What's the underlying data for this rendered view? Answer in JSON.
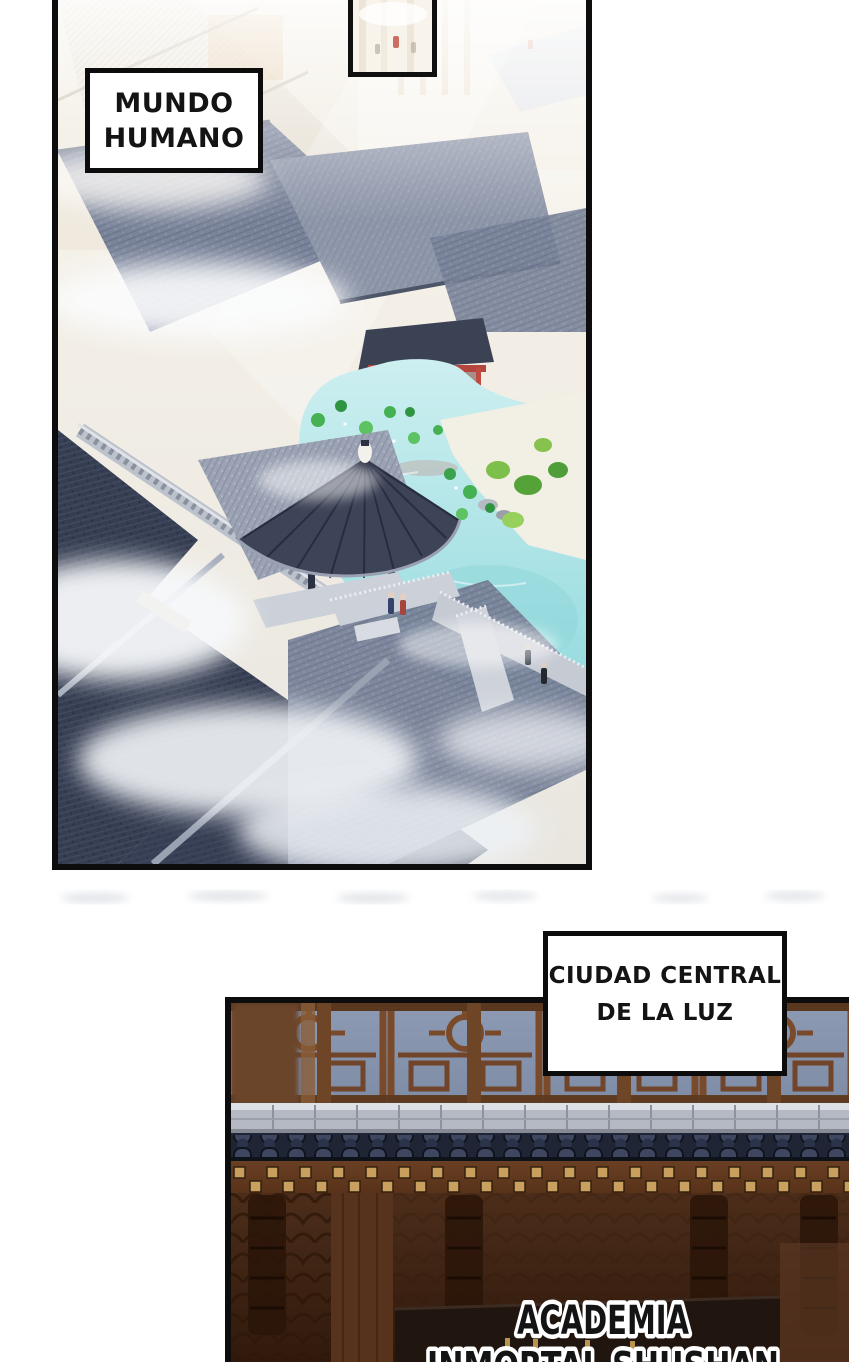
{
  "captions": {
    "human_world": {
      "line1": "MUNDO",
      "line2": "HUMANO"
    },
    "central_city": {
      "line1": "CIUDAD CENTRAL",
      "line2": "DE LA LUZ"
    },
    "academy": {
      "line1": "ACADEMIA",
      "line2": "INMORTAL SHUSHAN"
    }
  },
  "colors": {
    "page_background": "#ffffff",
    "panel_border": "#0d0d0d",
    "caption_box_background": "#ffffff",
    "caption_text": "#141414",
    "academy_text_fill": "#141414",
    "academy_text_outline": "#ffffff",
    "pond_water": "#a8e0e4",
    "lotus_green": "#46b152",
    "pavilion_red": "#c04b41",
    "roof_slate_light": "#9ba3b4",
    "roof_dark_navy": "#39415a",
    "mist_white": "#f4f6f8",
    "evening_sky": "#8795b0",
    "lattice_wood": "#7a4b2a",
    "wall_wood_dark": "#4c2d1a",
    "stud_gold": "#c99f5e",
    "stone_ledge": "#b4b9c3",
    "signboard_dark": "#211510"
  }
}
